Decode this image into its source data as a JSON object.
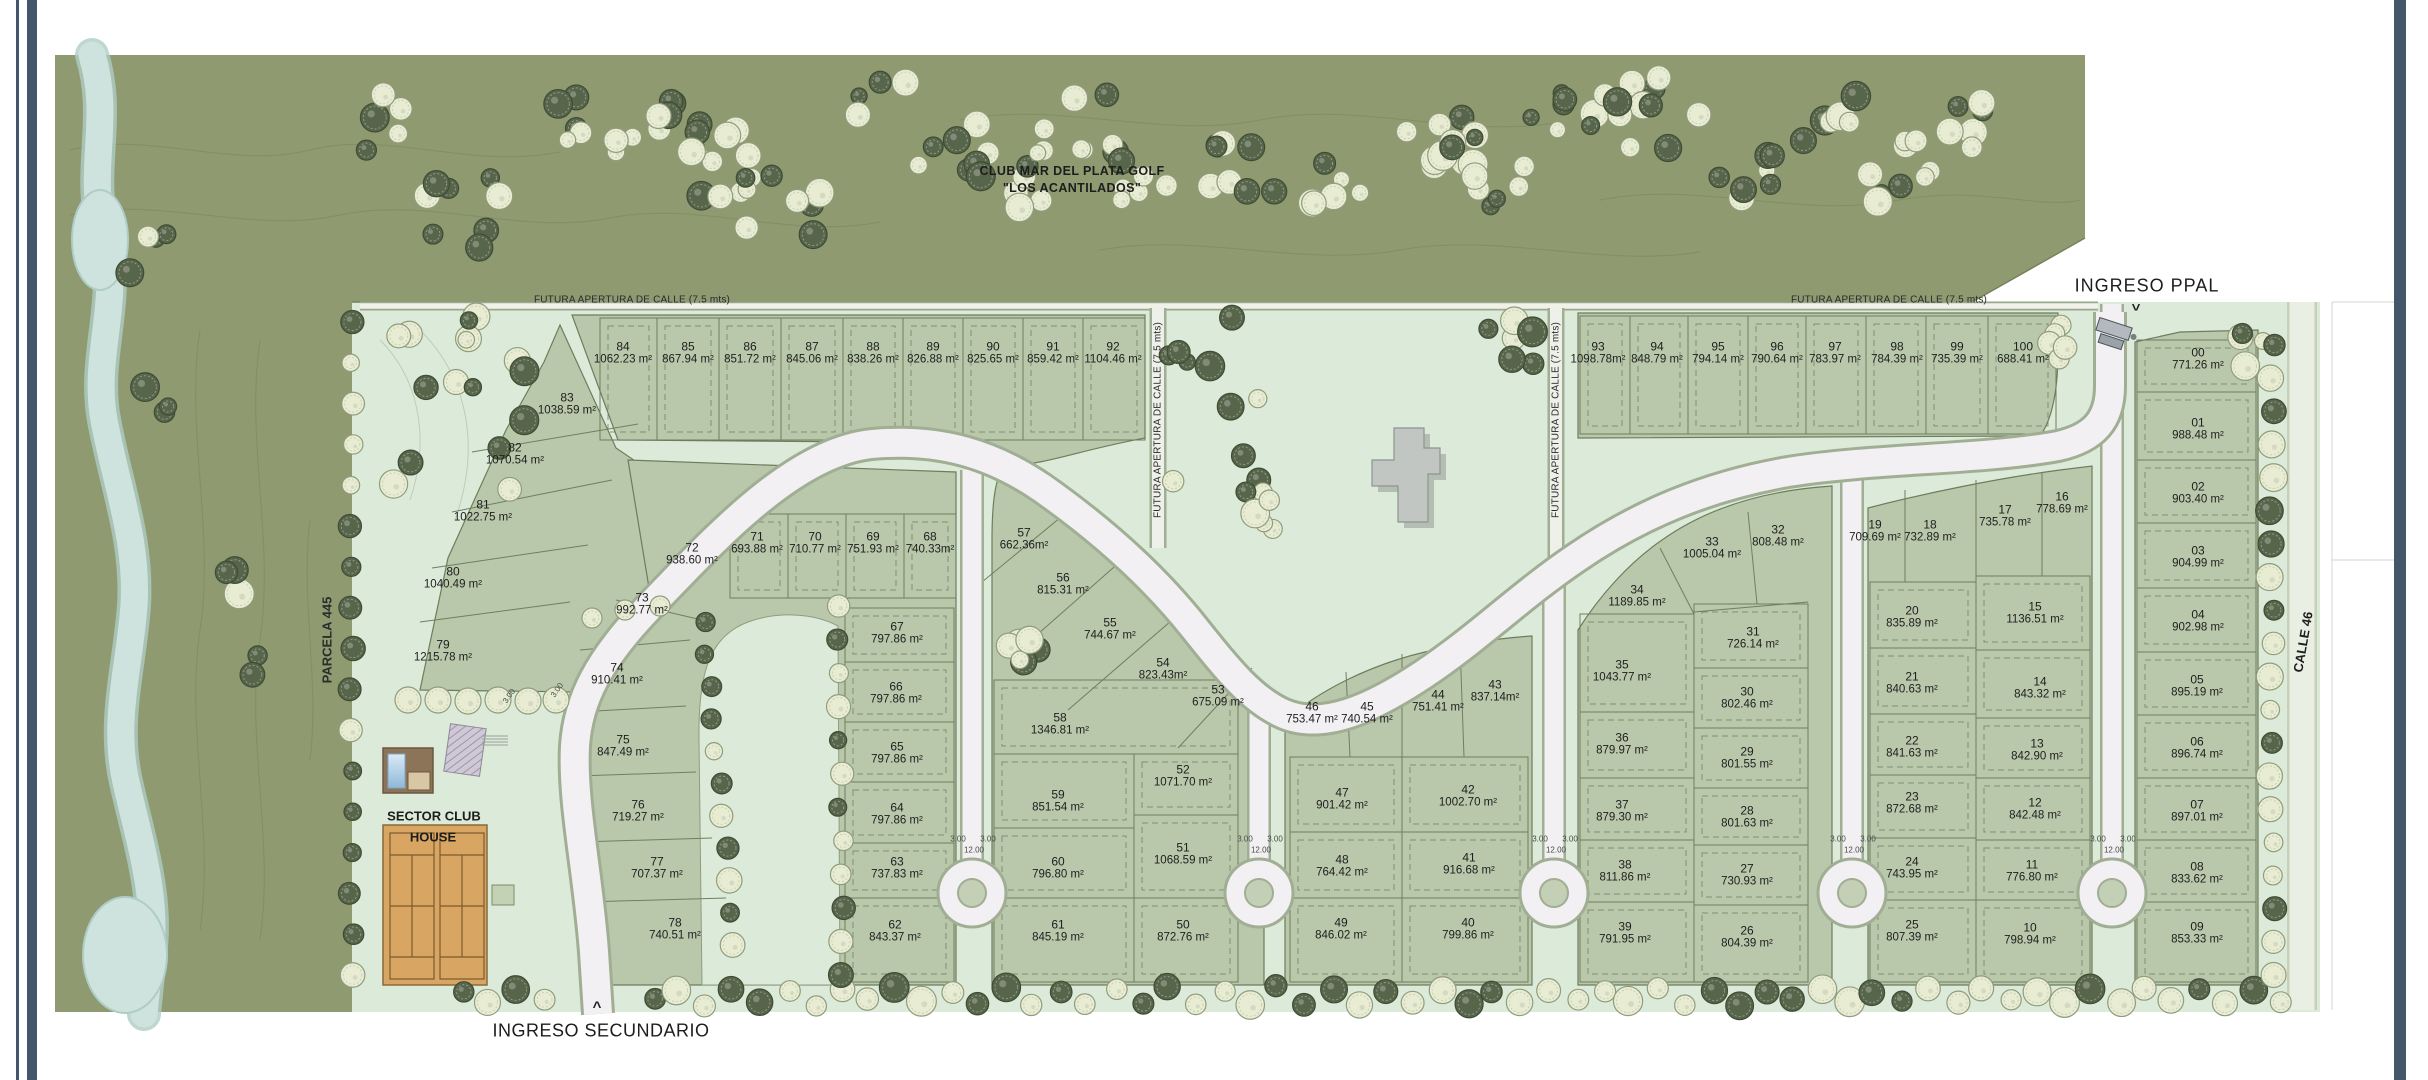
{
  "map": {
    "golf_title": [
      "CLUB MAR DEL PLATA GOLF",
      "\"LOS ACANTILADOS\""
    ],
    "entrances": {
      "main": "INGRESO PPAL",
      "secondary": "INGRESO SECUNDARIO"
    },
    "arrow": "^",
    "club_house": [
      "SECTOR CLUB",
      "HOUSE"
    ],
    "parcel_label": "PARCELA 445",
    "street_label": "CALLE 46",
    "future_street_label": "FUTURA APERTURA DE CALLE (7.5 mts)",
    "future_street_positions": [
      {
        "x": 632,
        "y": 300,
        "rot": 0
      },
      {
        "x": 1889,
        "y": 300,
        "rot": 0
      },
      {
        "x": 1158,
        "y": 420,
        "rot": -90
      },
      {
        "x": 1556,
        "y": 420,
        "rot": -90
      }
    ],
    "colors": {
      "golf_band": "#8f9a71",
      "plan_bg": "#dcead9",
      "lot_fill": "#b9c7ab",
      "road": "#f2f0f2",
      "water": "#cfe3de",
      "court": "#d9a562",
      "frame": "#43566a"
    },
    "dimensions": [
      {
        "t": "3.00",
        "x": 958,
        "y": 839,
        "rot": 0
      },
      {
        "t": "3.00",
        "x": 988,
        "y": 839,
        "rot": 0
      },
      {
        "t": "12.00",
        "x": 974,
        "y": 850,
        "rot": 0
      },
      {
        "t": "3.00",
        "x": 1245,
        "y": 839,
        "rot": 0
      },
      {
        "t": "3.00",
        "x": 1275,
        "y": 839,
        "rot": 0
      },
      {
        "t": "12.00",
        "x": 1261,
        "y": 850,
        "rot": 0
      },
      {
        "t": "3.00",
        "x": 1540,
        "y": 839,
        "rot": 0
      },
      {
        "t": "3.00",
        "x": 1570,
        "y": 839,
        "rot": 0
      },
      {
        "t": "12.00",
        "x": 1556,
        "y": 850,
        "rot": 0
      },
      {
        "t": "3.00",
        "x": 1838,
        "y": 839,
        "rot": 0
      },
      {
        "t": "3.00",
        "x": 1868,
        "y": 839,
        "rot": 0
      },
      {
        "t": "12.00",
        "x": 1854,
        "y": 850,
        "rot": 0
      },
      {
        "t": "3.00",
        "x": 2098,
        "y": 839,
        "rot": 0
      },
      {
        "t": "3.00",
        "x": 2128,
        "y": 839,
        "rot": 0
      },
      {
        "t": "12.00",
        "x": 2114,
        "y": 850,
        "rot": 0
      },
      {
        "t": "3.00",
        "x": 557,
        "y": 690,
        "rot": -55
      },
      {
        "t": "3.00",
        "x": 509,
        "y": 696,
        "rot": -55
      }
    ],
    "lots": [
      {
        "n": "00",
        "a": "771.26 m²",
        "x": 2198,
        "y": 358
      },
      {
        "n": "01",
        "a": "988.48 m²",
        "x": 2198,
        "y": 428
      },
      {
        "n": "02",
        "a": "903.40 m²",
        "x": 2198,
        "y": 492
      },
      {
        "n": "03",
        "a": "904.99 m²",
        "x": 2198,
        "y": 556
      },
      {
        "n": "04",
        "a": "902.98 m²",
        "x": 2198,
        "y": 620
      },
      {
        "n": "05",
        "a": "895.19 m²",
        "x": 2197,
        "y": 685
      },
      {
        "n": "06",
        "a": "896.74 m²",
        "x": 2197,
        "y": 747
      },
      {
        "n": "07",
        "a": "897.01 m²",
        "x": 2197,
        "y": 810
      },
      {
        "n": "08",
        "a": "833.62 m²",
        "x": 2197,
        "y": 872
      },
      {
        "n": "09",
        "a": "853.33 m²",
        "x": 2197,
        "y": 932
      },
      {
        "n": "10",
        "a": "798.94 m²",
        "x": 2030,
        "y": 933
      },
      {
        "n": "11",
        "a": "776.80 m²",
        "x": 2032,
        "y": 870
      },
      {
        "n": "12",
        "a": "842.48 m²",
        "x": 2035,
        "y": 808
      },
      {
        "n": "13",
        "a": "842.90 m²",
        "x": 2037,
        "y": 749
      },
      {
        "n": "14",
        "a": "843.32 m²",
        "x": 2040,
        "y": 687
      },
      {
        "n": "15",
        "a": "1136.51 m²",
        "x": 2035,
        "y": 612
      },
      {
        "n": "16",
        "a": "778.69 m²",
        "x": 2062,
        "y": 502
      },
      {
        "n": "17",
        "a": "735.78 m²",
        "x": 2005,
        "y": 515
      },
      {
        "n": "18",
        "a": "732.89 m²",
        "x": 1930,
        "y": 530
      },
      {
        "n": "19",
        "a": "709.69 m²",
        "x": 1875,
        "y": 530
      },
      {
        "n": "20",
        "a": "835.89 m²",
        "x": 1912,
        "y": 616
      },
      {
        "n": "21",
        "a": "840.63 m²",
        "x": 1912,
        "y": 682
      },
      {
        "n": "22",
        "a": "841.63 m²",
        "x": 1912,
        "y": 746
      },
      {
        "n": "23",
        "a": "872.68 m²",
        "x": 1912,
        "y": 802
      },
      {
        "n": "24",
        "a": "743.95 m²",
        "x": 1912,
        "y": 867
      },
      {
        "n": "25",
        "a": "807.39 m²",
        "x": 1912,
        "y": 930
      },
      {
        "n": "26",
        "a": "804.39 m²",
        "x": 1747,
        "y": 936
      },
      {
        "n": "27",
        "a": "730.93 m²",
        "x": 1747,
        "y": 874
      },
      {
        "n": "28",
        "a": "801.63 m²",
        "x": 1747,
        "y": 816
      },
      {
        "n": "29",
        "a": "801.55 m²",
        "x": 1747,
        "y": 757
      },
      {
        "n": "30",
        "a": "802.46 m²",
        "x": 1747,
        "y": 697
      },
      {
        "n": "31",
        "a": "726.14 m²",
        "x": 1753,
        "y": 637
      },
      {
        "n": "32",
        "a": "808.48 m²",
        "x": 1778,
        "y": 535
      },
      {
        "n": "33",
        "a": "1005.04 m²",
        "x": 1712,
        "y": 547
      },
      {
        "n": "34",
        "a": "1189.85 m²",
        "x": 1637,
        "y": 595
      },
      {
        "n": "35",
        "a": "1043.77 m²",
        "x": 1622,
        "y": 670
      },
      {
        "n": "36",
        "a": "879.97 m²",
        "x": 1622,
        "y": 743
      },
      {
        "n": "37",
        "a": "879.30 m²",
        "x": 1622,
        "y": 810
      },
      {
        "n": "38",
        "a": "811.86 m²",
        "x": 1625,
        "y": 870
      },
      {
        "n": "39",
        "a": "791.95 m²",
        "x": 1625,
        "y": 932
      },
      {
        "n": "40",
        "a": "799.86 m²",
        "x": 1468,
        "y": 928
      },
      {
        "n": "41",
        "a": "916.68 m²",
        "x": 1469,
        "y": 863
      },
      {
        "n": "42",
        "a": "1002.70 m²",
        "x": 1468,
        "y": 795
      },
      {
        "n": "43",
        "a": "837.14m²",
        "x": 1495,
        "y": 690
      },
      {
        "n": "44",
        "a": "751.41 m²",
        "x": 1438,
        "y": 700
      },
      {
        "n": "45",
        "a": "740.54 m²",
        "x": 1367,
        "y": 712
      },
      {
        "n": "46",
        "a": "753.47 m²",
        "x": 1312,
        "y": 712
      },
      {
        "n": "47",
        "a": "901.42 m²",
        "x": 1342,
        "y": 798
      },
      {
        "n": "48",
        "a": "764.42 m²",
        "x": 1342,
        "y": 865
      },
      {
        "n": "49",
        "a": "846.02 m²",
        "x": 1341,
        "y": 928
      },
      {
        "n": "50",
        "a": "872.76 m²",
        "x": 1183,
        "y": 930
      },
      {
        "n": "51",
        "a": "1068.59 m²",
        "x": 1183,
        "y": 853
      },
      {
        "n": "52",
        "a": "1071.70 m²",
        "x": 1183,
        "y": 775
      },
      {
        "n": "53",
        "a": "675.09 m²",
        "x": 1218,
        "y": 695
      },
      {
        "n": "54",
        "a": "823.43m²",
        "x": 1163,
        "y": 668
      },
      {
        "n": "55",
        "a": "744.67 m²",
        "x": 1110,
        "y": 628
      },
      {
        "n": "56",
        "a": "815.31 m²",
        "x": 1063,
        "y": 583
      },
      {
        "n": "57",
        "a": "662.36m²",
        "x": 1024,
        "y": 538
      },
      {
        "n": "58",
        "a": "1346.81 m²",
        "x": 1060,
        "y": 723
      },
      {
        "n": "59",
        "a": "851.54 m²",
        "x": 1058,
        "y": 800
      },
      {
        "n": "60",
        "a": "796.80 m²",
        "x": 1058,
        "y": 867
      },
      {
        "n": "61",
        "a": "845.19 m²",
        "x": 1058,
        "y": 930
      },
      {
        "n": "62",
        "a": "843.37 m²",
        "x": 895,
        "y": 930
      },
      {
        "n": "63",
        "a": "737.83 m²",
        "x": 897,
        "y": 867
      },
      {
        "n": "64",
        "a": "797.86 m²",
        "x": 897,
        "y": 813
      },
      {
        "n": "65",
        "a": "797.86 m²",
        "x": 897,
        "y": 752
      },
      {
        "n": "66",
        "a": "797.86 m²",
        "x": 896,
        "y": 692
      },
      {
        "n": "67",
        "a": "797.86 m²",
        "x": 897,
        "y": 632
      },
      {
        "n": "68",
        "a": "740.33m²",
        "x": 930,
        "y": 542
      },
      {
        "n": "69",
        "a": "751.93 m²",
        "x": 873,
        "y": 542
      },
      {
        "n": "70",
        "a": "710.77 m²",
        "x": 815,
        "y": 542
      },
      {
        "n": "71",
        "a": "693.88 m²",
        "x": 757,
        "y": 542
      },
      {
        "n": "72",
        "a": "938.60 m²",
        "x": 692,
        "y": 553
      },
      {
        "n": "73",
        "a": "992.77 m²",
        "x": 642,
        "y": 603
      },
      {
        "n": "74",
        "a": "910.41 m²",
        "x": 617,
        "y": 673
      },
      {
        "n": "75",
        "a": "847.49 m²",
        "x": 623,
        "y": 745
      },
      {
        "n": "76",
        "a": "719.27 m²",
        "x": 638,
        "y": 810
      },
      {
        "n": "77",
        "a": "707.37 m²",
        "x": 657,
        "y": 867
      },
      {
        "n": "78",
        "a": "740.51 m²",
        "x": 675,
        "y": 928
      },
      {
        "n": "79",
        "a": "1215.78 m²",
        "x": 443,
        "y": 650
      },
      {
        "n": "80",
        "a": "1040.49 m²",
        "x": 453,
        "y": 577
      },
      {
        "n": "81",
        "a": "1022.75 m²",
        "x": 483,
        "y": 510
      },
      {
        "n": "82",
        "a": "1070.54 m²",
        "x": 515,
        "y": 453
      },
      {
        "n": "83",
        "a": "1038.59 m²",
        "x": 567,
        "y": 403
      },
      {
        "n": "84",
        "a": "1062.23 m²",
        "x": 623,
        "y": 352
      },
      {
        "n": "85",
        "a": "867.94 m²",
        "x": 688,
        "y": 352
      },
      {
        "n": "86",
        "a": "851.72 m²",
        "x": 750,
        "y": 352
      },
      {
        "n": "87",
        "a": "845.06 m²",
        "x": 812,
        "y": 352
      },
      {
        "n": "88",
        "a": "838.26 m²",
        "x": 873,
        "y": 352
      },
      {
        "n": "89",
        "a": "826.88 m²",
        "x": 933,
        "y": 352
      },
      {
        "n": "90",
        "a": "825.65 m²",
        "x": 993,
        "y": 352
      },
      {
        "n": "91",
        "a": "859.42 m²",
        "x": 1053,
        "y": 352
      },
      {
        "n": "92",
        "a": "1104.46 m²",
        "x": 1113,
        "y": 352
      },
      {
        "n": "93",
        "a": "1098.78m²",
        "x": 1598,
        "y": 352
      },
      {
        "n": "94",
        "a": "848.79 m²",
        "x": 1657,
        "y": 352
      },
      {
        "n": "95",
        "a": "794.14 m²",
        "x": 1718,
        "y": 352
      },
      {
        "n": "96",
        "a": "790.64 m²",
        "x": 1777,
        "y": 352
      },
      {
        "n": "97",
        "a": "783.97 m²",
        "x": 1835,
        "y": 352
      },
      {
        "n": "98",
        "a": "784.39 m²",
        "x": 1897,
        "y": 352
      },
      {
        "n": "99",
        "a": "735.39 m²",
        "x": 1957,
        "y": 352
      },
      {
        "n": "100",
        "a": "688.41 m²",
        "x": 2023,
        "y": 352
      }
    ]
  }
}
